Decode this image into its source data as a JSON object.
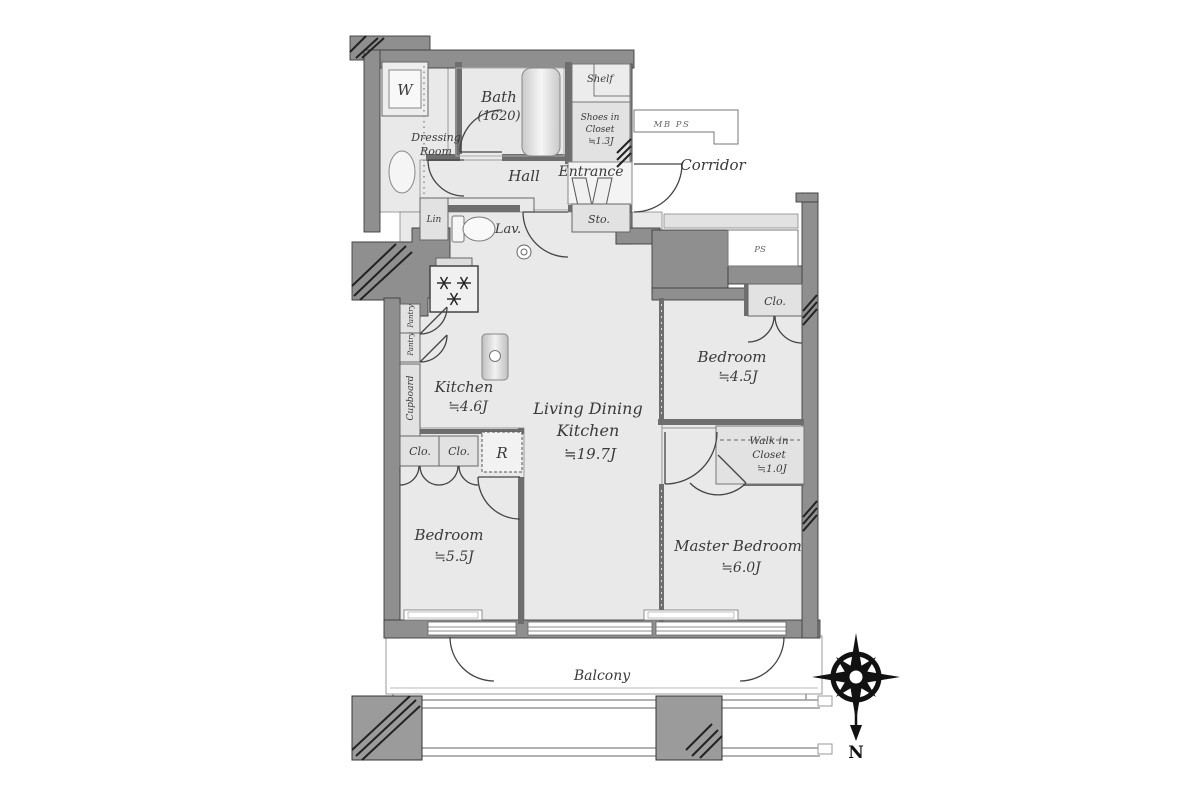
{
  "fp": {
    "sanitary": {
      "washer": "W",
      "dressing1": "Dressing",
      "dressing2": "Room",
      "bath": "Bath",
      "bath_size": "(1620)",
      "lav": "Lav.",
      "linen": "Lin"
    },
    "entry": {
      "shelf": "Shelf",
      "shoes1": "Shoes in",
      "shoes2": "Closet",
      "shoes3": "≒1.3J",
      "hall": "Hall",
      "entrance": "Entrance",
      "storage": "Sto.",
      "corridor": "Corridor",
      "mb_ps": "MB PS",
      "ps": "PS"
    },
    "kitchen": {
      "name": "Kitchen",
      "size": "≒4.6J",
      "pantry_a": "Pantry",
      "pantry_b": "Pantry",
      "cupboard": "Cupboard",
      "fridge": "R"
    },
    "ldk": {
      "line1": "Living Dining",
      "line2": "Kitchen",
      "size": "≒19.7J"
    },
    "bedroom_ne": {
      "name": "Bedroom",
      "size": "≒4.5J",
      "closet": "Clo."
    },
    "bedroom_sw": {
      "name": "Bedroom",
      "size": "≒5.5J",
      "closet_a": "Clo.",
      "closet_b": "Clo."
    },
    "master": {
      "name": "Master Bedroom",
      "size": "≒6.0J",
      "wic1": "Walk in",
      "wic2": "Closet",
      "wic3": "≒1.0J"
    },
    "balcony": {
      "name": "Balcony"
    },
    "compass": {
      "north": "N"
    },
    "colors": {
      "wall": "#8f8f8f",
      "floor": "#e9e9e9",
      "closet": "#e2e2e2",
      "line": "#3f3f3f",
      "text": "#3a3a3a"
    }
  }
}
